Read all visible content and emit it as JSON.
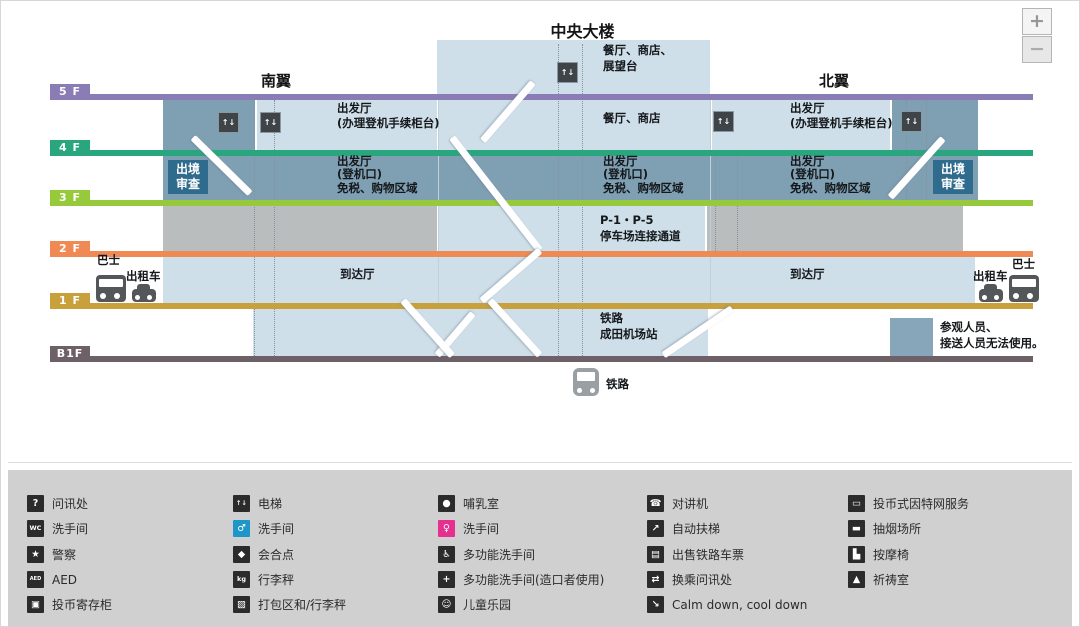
{
  "title": "中央大楼",
  "zoom_controls": {
    "zoom_in": "+",
    "zoom_out": "−"
  },
  "wings": {
    "south": "南翼",
    "north": "北翼"
  },
  "floors": [
    {
      "label": "5 F",
      "color": "#8a7cb4"
    },
    {
      "label": "4 F",
      "color": "#2aa67e"
    },
    {
      "label": "3 F",
      "color": "#97c93d"
    },
    {
      "label": "2 F",
      "color": "#f08a55"
    },
    {
      "label": "1 F",
      "color": "#c8a03c"
    },
    {
      "label": "B1F",
      "color": "#6e6067"
    }
  ],
  "map": {
    "rooftop": {
      "line1": "餐厅、商店、",
      "line2": "展望台"
    },
    "center_5f": "餐厅、商店",
    "checkin": {
      "line1": "出发厅",
      "line2": "(办理登机手续柜台)"
    },
    "gates": {
      "line1": "出发厅",
      "line2": "(登机口)",
      "line3": "免税、购物区域"
    },
    "immigration": {
      "line1": "出境",
      "line2": "审查"
    },
    "parking": {
      "line1": "P-1・P-5",
      "line2": "停车场连接通道"
    },
    "arrivals": "到达厅",
    "rail_station": {
      "line1": "铁路",
      "line2": "成田机场站"
    },
    "rail_bottom": "铁路",
    "notice": {
      "line1": "参观人员、",
      "line2": "接送人员无法使用。",
      "swatch_color": "#88a6ba"
    },
    "transport": {
      "bus": "巴士",
      "taxi": "出租车"
    },
    "region_colors": {
      "public_light_blue": "#cfdfe9",
      "secure_dark_blue": "#7f9fb3",
      "parking_gray": "#b9bdbd",
      "immigration_box": "#2f6b8c"
    }
  },
  "legend": {
    "columns": [
      {
        "items": [
          {
            "icon": "information-icon",
            "glyph": "?",
            "label": "问讯处",
            "color": "#2b2b2b"
          },
          {
            "icon": "restroom-icon",
            "glyph": "WC",
            "label": "洗手间",
            "color": "#2b2b2b"
          },
          {
            "icon": "police-icon",
            "glyph": "★",
            "label": "警察",
            "color": "#2b2b2b"
          },
          {
            "icon": "aed-icon",
            "glyph": "AED",
            "label": "AED",
            "color": "#2b2b2b"
          },
          {
            "icon": "coin-locker-icon",
            "glyph": "▣",
            "label": "投币寄存柜",
            "color": "#2b2b2b"
          }
        ]
      },
      {
        "items": [
          {
            "icon": "elevator-icon",
            "glyph": "↑↓",
            "label": "电梯",
            "color": "#2b2b2b"
          },
          {
            "icon": "mens-restroom-icon",
            "glyph": "♂",
            "label": "洗手间",
            "color": "#1e96c8"
          },
          {
            "icon": "meeting-point-icon",
            "glyph": "◆",
            "label": "会合点",
            "color": "#2b2b2b"
          },
          {
            "icon": "luggage-scale-icon",
            "glyph": "kg",
            "label": "行李秤",
            "color": "#2b2b2b"
          },
          {
            "icon": "packing-area-icon",
            "glyph": "▧",
            "label": "打包区和/行李秤",
            "color": "#2b2b2b"
          }
        ]
      },
      {
        "items": [
          {
            "icon": "nursing-room-icon",
            "glyph": "●",
            "label": "哺乳室",
            "color": "#2b2b2b"
          },
          {
            "icon": "womens-restroom-icon",
            "glyph": "♀",
            "label": "洗手间",
            "color": "#e6308f"
          },
          {
            "icon": "accessible-restroom-icon",
            "glyph": "♿",
            "label": "多功能洗手间",
            "color": "#2b2b2b"
          },
          {
            "icon": "ostomate-restroom-icon",
            "glyph": "+",
            "label": "多功能洗手间(造口者使用)",
            "color": "#2b2b2b"
          },
          {
            "icon": "kids-park-icon",
            "glyph": "☺",
            "label": "儿童乐园",
            "color": "#2b2b2b"
          }
        ]
      },
      {
        "items": [
          {
            "icon": "intercom-icon",
            "glyph": "☎",
            "label": "对讲机",
            "color": "#2b2b2b"
          },
          {
            "icon": "escalator-icon",
            "glyph": "↗",
            "label": "自动扶梯",
            "color": "#2b2b2b"
          },
          {
            "icon": "rail-ticket-icon",
            "glyph": "▤",
            "label": "出售铁路车票",
            "color": "#2b2b2b"
          },
          {
            "icon": "transfer-information-icon",
            "glyph": "⇄",
            "label": "换乘问讯处",
            "color": "#2b2b2b"
          },
          {
            "icon": "calm-down-icon",
            "glyph": "↘",
            "label": "Calm down, cool down",
            "color": "#2b2b2b"
          }
        ]
      },
      {
        "items": [
          {
            "icon": "internet-service-icon",
            "glyph": "▭",
            "label": "投币式因特网服务",
            "color": "#2b2b2b"
          },
          {
            "icon": "smoking-area-icon",
            "glyph": "▬",
            "label": "抽烟场所",
            "color": "#2b2b2b"
          },
          {
            "icon": "massage-chair-icon",
            "glyph": "▙",
            "label": "按摩椅",
            "color": "#2b2b2b"
          },
          {
            "icon": "prayer-room-icon",
            "glyph": "▲",
            "label": "祈祷室",
            "color": "#2b2b2b"
          }
        ]
      }
    ]
  }
}
